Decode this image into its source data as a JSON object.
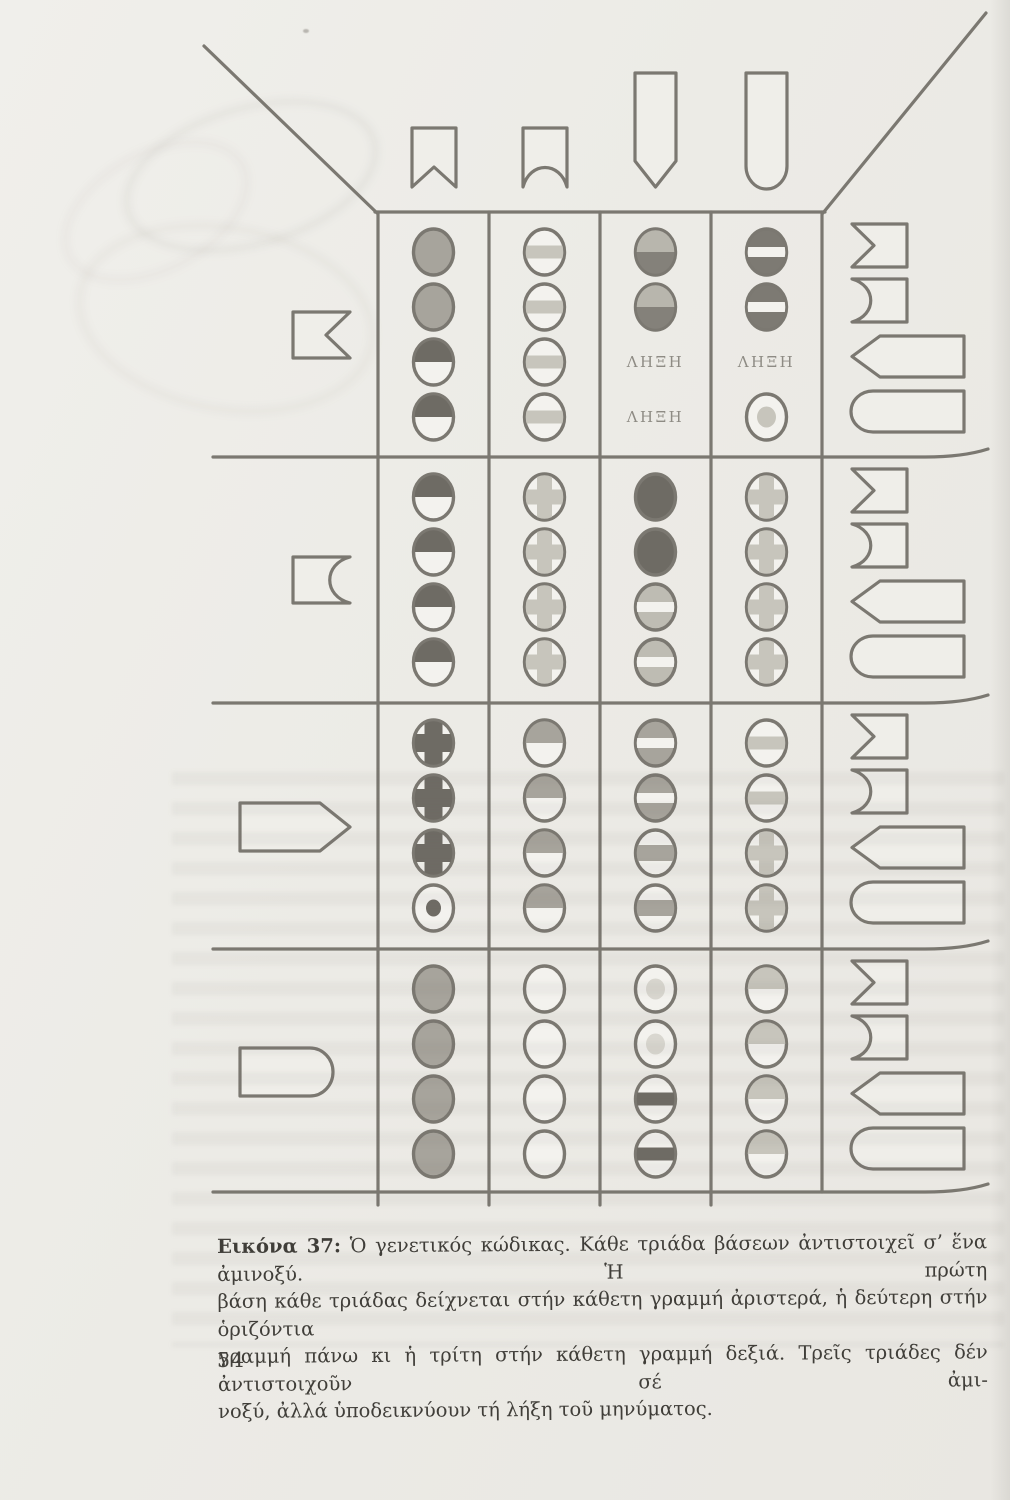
{
  "page_number": "54",
  "caption": {
    "label": "Εικόνα 37:",
    "line1": "Ὁ γενετικός κώδικας. Κάθε τριάδα βάσεων ἀντιστοιχεῖ σ’ ἕνα ἀμινοξύ. Ἡ πρώτη",
    "line2": "βάση κάθε τριάδας δείχνεται στήν κάθετη γραμμή ἀριστερά, ἡ δεύτερη στήν ὁριζόντια",
    "line3": "γραμμή πάνω κι ἡ τρίτη στήν κάθετη γραμμή δεξιά. Τρεῖς τριάδες δέν ἀντιστοιχοῦν σέ ἀμι-",
    "line4": "νοξύ, ἀλλά ὑποδεικνύουν τή λήξη τοῦ μηνύματος."
  },
  "diagram": {
    "stop_label": "ΛΗΞΗ",
    "palette": {
      "line": "#7b7871",
      "white": "#f3f2ee",
      "light": "#c7c5bc",
      "light2": "#bebcb3",
      "medium": "#a7a49c",
      "dark": "#6e6b64",
      "dark2": "#7d7a73",
      "faint": "#d9d7d0",
      "tyr_top": "#b8b6ad",
      "tyr_bottom": "#84817a",
      "stop_text": "#8e8b84",
      "shape_fill": "#efeee9"
    },
    "first_base_shapes": [
      "notch-v",
      "notch-round",
      "point",
      "round"
    ],
    "second_base_shapes": [
      "notch-v",
      "notch-round",
      "point",
      "round"
    ],
    "third_base_shapes": [
      "notch-v",
      "notch-round",
      "point",
      "round"
    ],
    "cells": [
      [
        [
          "solid-medium",
          "solid-medium",
          "half-top-dark",
          "half-top-dark"
        ],
        [
          "band-light",
          "band-light",
          "band-light",
          "band-light"
        ],
        [
          "half-light-dark",
          "half-light-dark",
          "stop",
          "stop"
        ],
        [
          "disc-dark-white-band",
          "disc-dark-white-band",
          "stop",
          "dot-light"
        ]
      ],
      [
        [
          "half-top-dark",
          "half-top-dark",
          "half-top-dark",
          "half-top-dark"
        ],
        [
          "cross-light",
          "cross-light",
          "cross-light",
          "cross-light"
        ],
        [
          "solid-dark",
          "solid-dark",
          "disc-light-white-band",
          "disc-light-white-band"
        ],
        [
          "cross-light",
          "cross-light",
          "cross-light",
          "cross-light"
        ]
      ],
      [
        [
          "cross-dark",
          "cross-dark",
          "cross-dark",
          "dot-dark"
        ],
        [
          "half-top-medium",
          "half-top-medium",
          "half-top-medium",
          "half-top-medium"
        ],
        [
          "disc-medium-white-band",
          "disc-medium-white-band",
          "band-medium",
          "band-medium"
        ],
        [
          "band-light",
          "band-light",
          "cross-light",
          "cross-light"
        ]
      ],
      [
        [
          "solid-medium",
          "solid-medium",
          "solid-medium",
          "solid-medium"
        ],
        [
          "empty",
          "empty",
          "empty",
          "empty"
        ],
        [
          "dot-faint",
          "dot-faint",
          "band-dark",
          "band-dark"
        ],
        [
          "half-top-light",
          "half-top-light",
          "half-top-light",
          "half-top-light"
        ]
      ]
    ]
  }
}
